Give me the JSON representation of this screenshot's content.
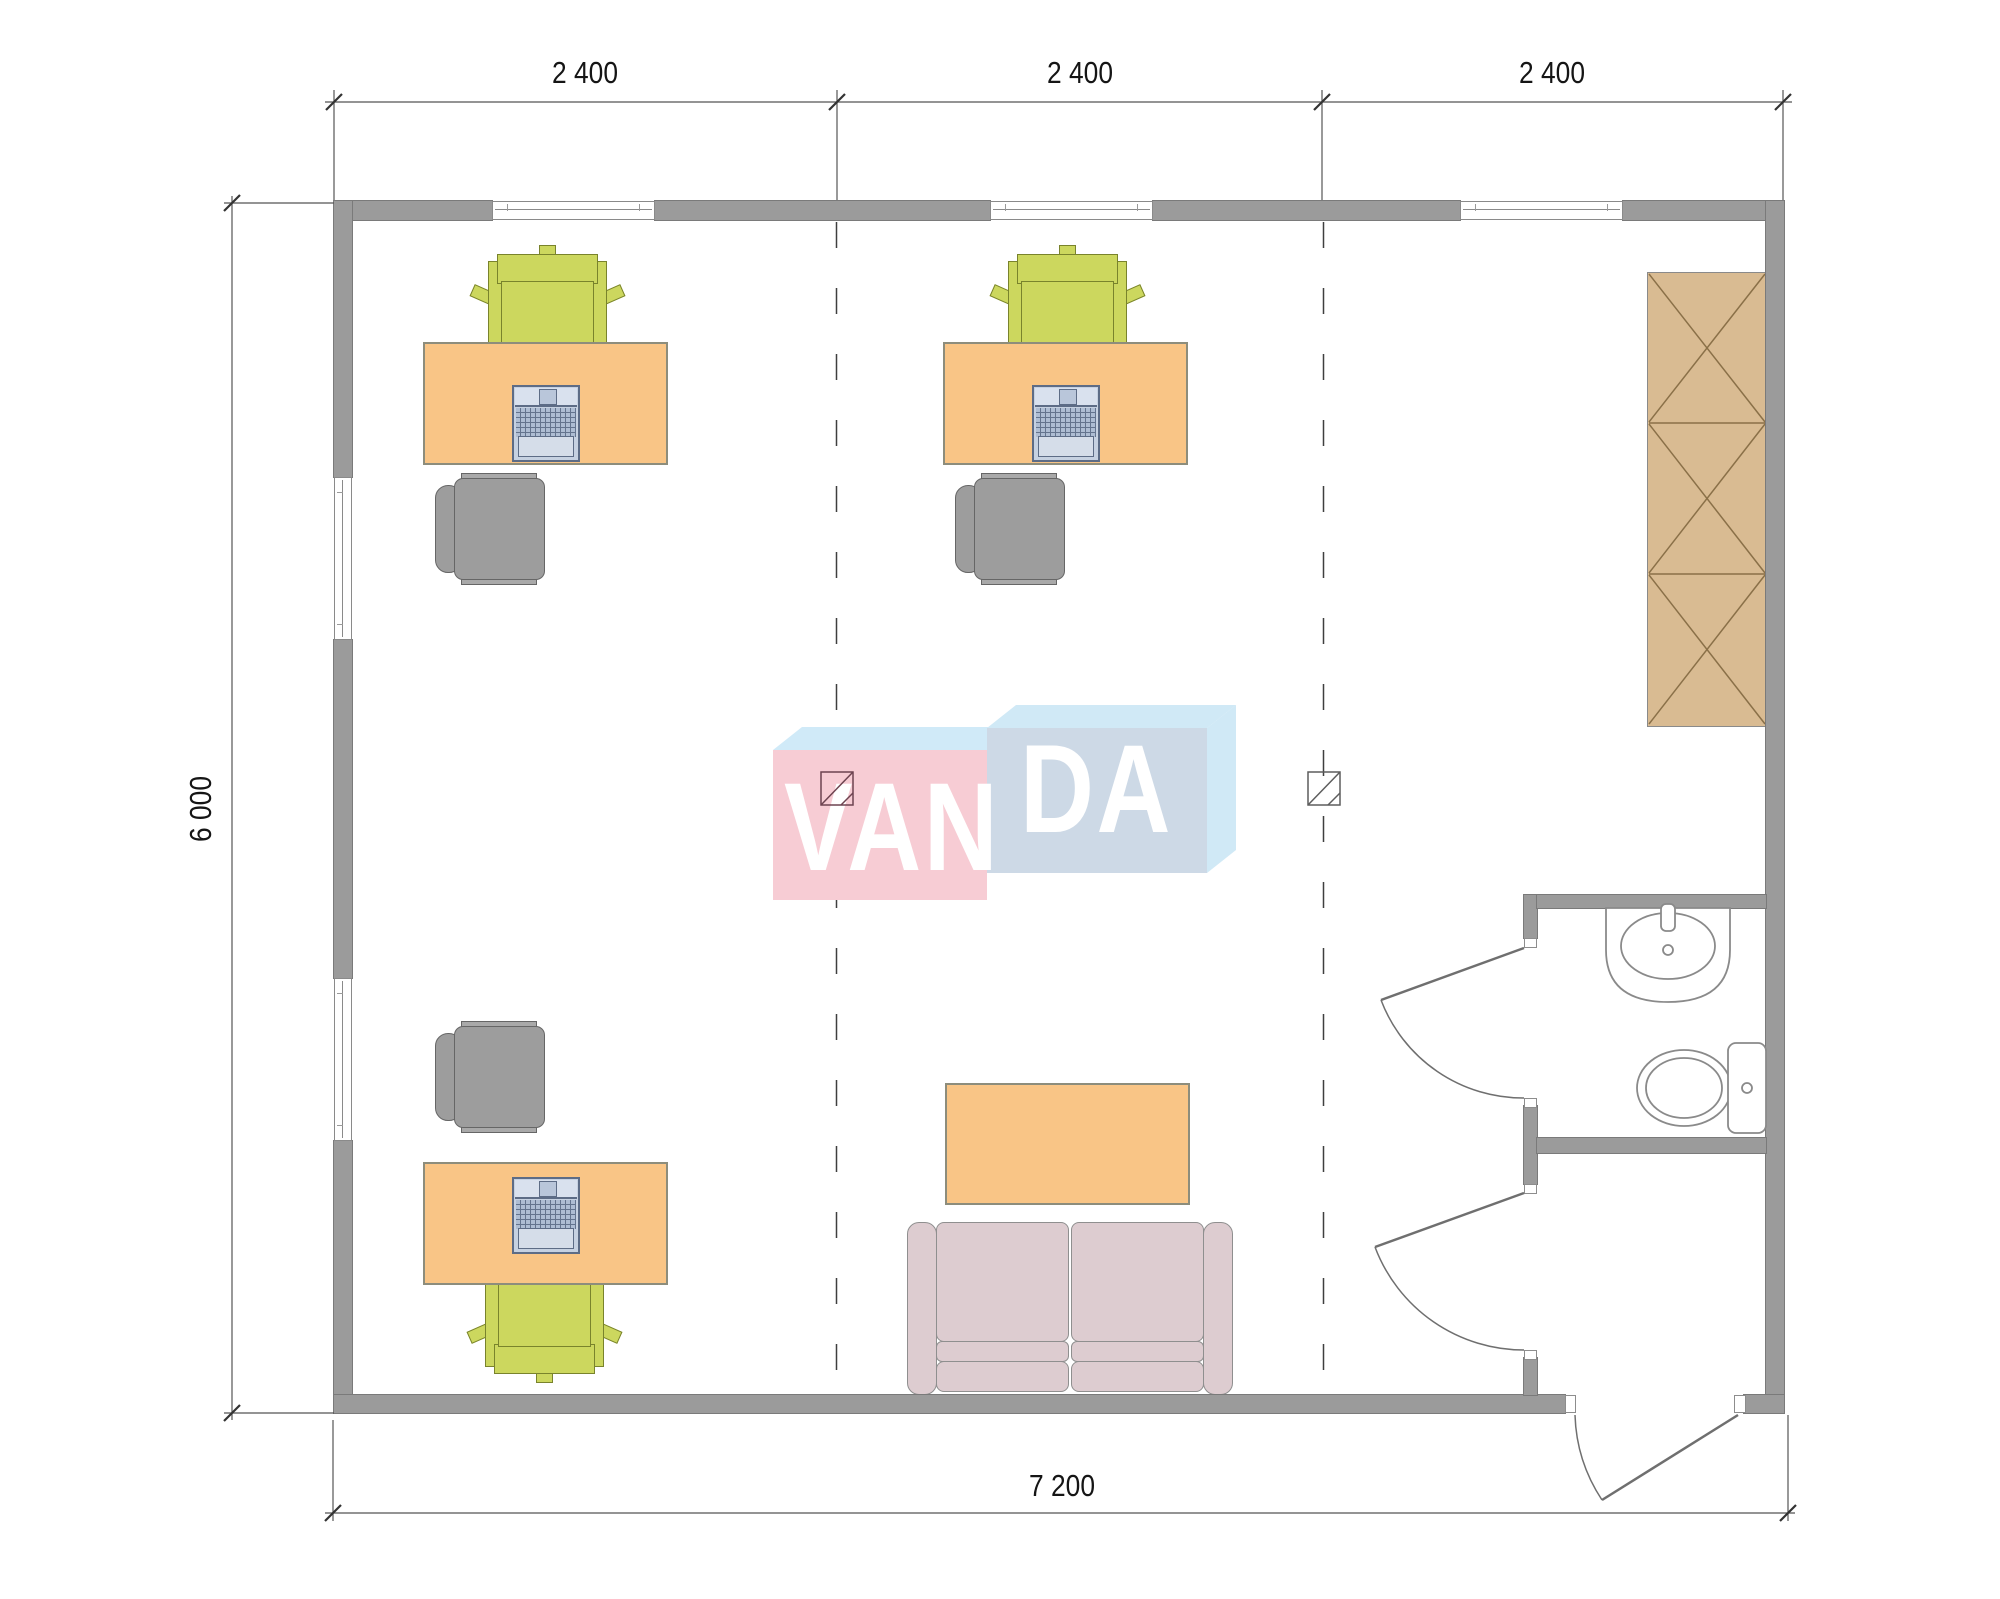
{
  "plan": {
    "logo": {
      "text": "VANDA",
      "left": "VAN",
      "right": "DA"
    },
    "dimensions": {
      "top": [
        "2 400",
        "2 400",
        "2 400"
      ],
      "left": "6 000",
      "bottom": "7 200"
    },
    "furniture": [
      {
        "item": "desk-with-laptop",
        "count": 3
      },
      {
        "item": "task-chair-green",
        "count": 3
      },
      {
        "item": "office-chair-gray",
        "count": 3
      },
      {
        "item": "wardrobe-three-section",
        "count": 1
      },
      {
        "item": "two-seat-sofa",
        "count": 1
      },
      {
        "item": "coffee-table",
        "count": 1
      },
      {
        "item": "wash-basin",
        "count": 1
      },
      {
        "item": "toilet",
        "count": 1
      }
    ],
    "openings": {
      "windows_top": 3,
      "windows_left": 2,
      "interior_doors": 2,
      "entrance_doors": 1
    },
    "colors": {
      "wall": "#9b9b9b",
      "desk": "#f9c586",
      "task_chair": "#ccd75e",
      "office_chair": "#9d9d9d",
      "wardrobe": "#d9bb92",
      "sofa": "#ddccd0",
      "laptop": "#c6d1e1",
      "logo_pink": "#f7ccd4",
      "logo_blue_front": "#cdd9e6",
      "logo_blue_top": "#d0e9f6",
      "dashed_grid_line": "#3f3f3f",
      "dimension_text": "#151515"
    }
  }
}
